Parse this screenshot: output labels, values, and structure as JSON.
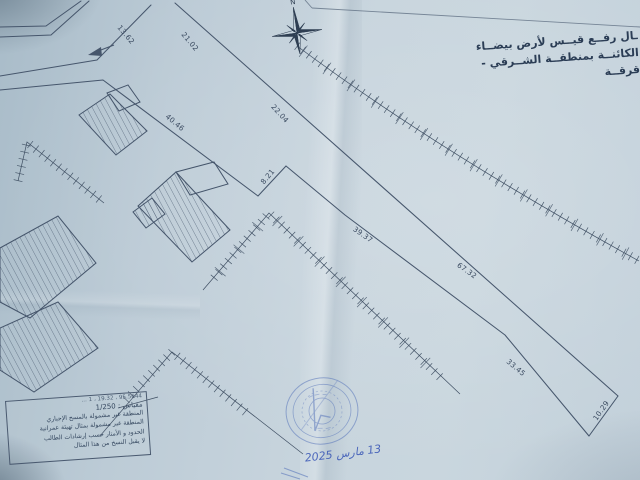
{
  "photo": {
    "title": {
      "line1": "ـال رفــع قيــس لأرض بيضــاء",
      "line2": "الكائنــة بمنطقــة الشــرقي - قرقــة"
    },
    "compass_label": "N",
    "measurements": [
      {
        "value": "13.62"
      },
      {
        "value": "21.02"
      },
      {
        "value": "40.46"
      },
      {
        "value": "22.04"
      },
      {
        "value": "8.21"
      },
      {
        "value": "39.37"
      },
      {
        "value": "67.32"
      },
      {
        "value": "33.45"
      },
      {
        "value": "10.29"
      }
    ],
    "legend": {
      "ref_line": "95.5644 ، 19.32 ، 1 …",
      "scale_line": "مقياس : 1/250",
      "notes": [
        "المنطقة غير مشمولة بالمسح الإجباري",
        "المنطقة غير مشمولة بمثال تهيئة عمرانية",
        "الحدود و الأمتار حسب إرشادات الطالب",
        "لا يقبل النسخ من هذا المثال"
      ]
    },
    "stamp_date": "13 مارس 2025",
    "colors": {
      "paper": "#bccbd6",
      "ink": "#46566c",
      "stamp_ink": "#5a77bb",
      "handwriting": "#3553b5"
    }
  }
}
